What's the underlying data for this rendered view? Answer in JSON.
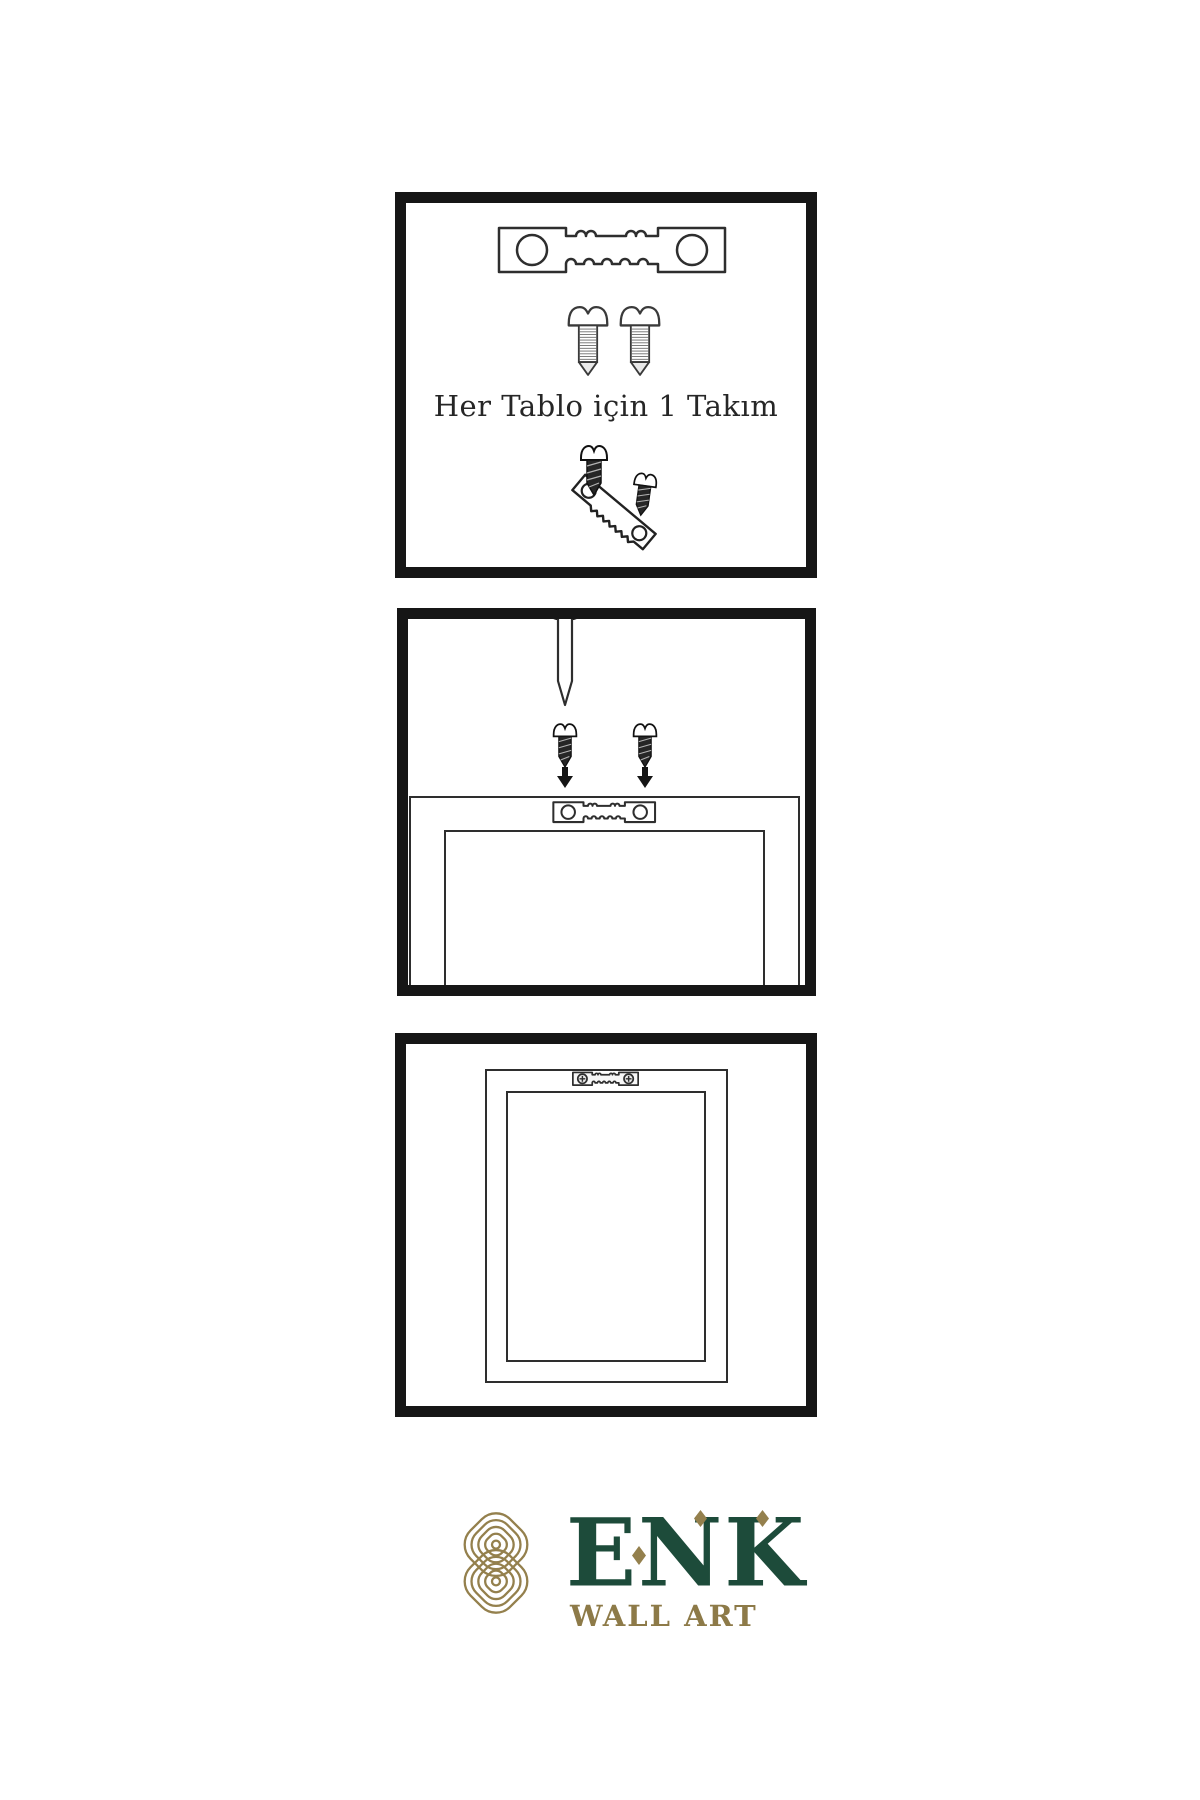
{
  "page": {
    "background": "#ffffff",
    "kind": "wall-art hanging instruction sheet"
  },
  "colors": {
    "ink": "#161616",
    "line": "#2e2e2e",
    "green": "#1d4b3a",
    "gold": "#94804d",
    "gold-text": "#8d7a48"
  },
  "panel_kit": {
    "caption": "Her Tablo için 1 Takım",
    "icons": [
      "sawtooth-hanger-icon",
      "screw-icon",
      "screw-icon",
      "dark-screw-icon",
      "tilted-sawtooth-hanger-icon",
      "dark-screw-icon"
    ]
  },
  "panel_mount": {
    "icons": [
      "wall-nail-icon",
      "dark-screw-icon",
      "dark-screw-icon",
      "down-arrow-icon",
      "down-arrow-icon",
      "frame-back-outline",
      "sawtooth-hanger-icon"
    ]
  },
  "panel_hang": {
    "icons": [
      "frame-back-outline",
      "installed-sawtooth-hanger-icon"
    ]
  },
  "logo": {
    "brand": "ENK",
    "subtitle": "WALL ART",
    "mark": "interlocked-knot-icon"
  }
}
